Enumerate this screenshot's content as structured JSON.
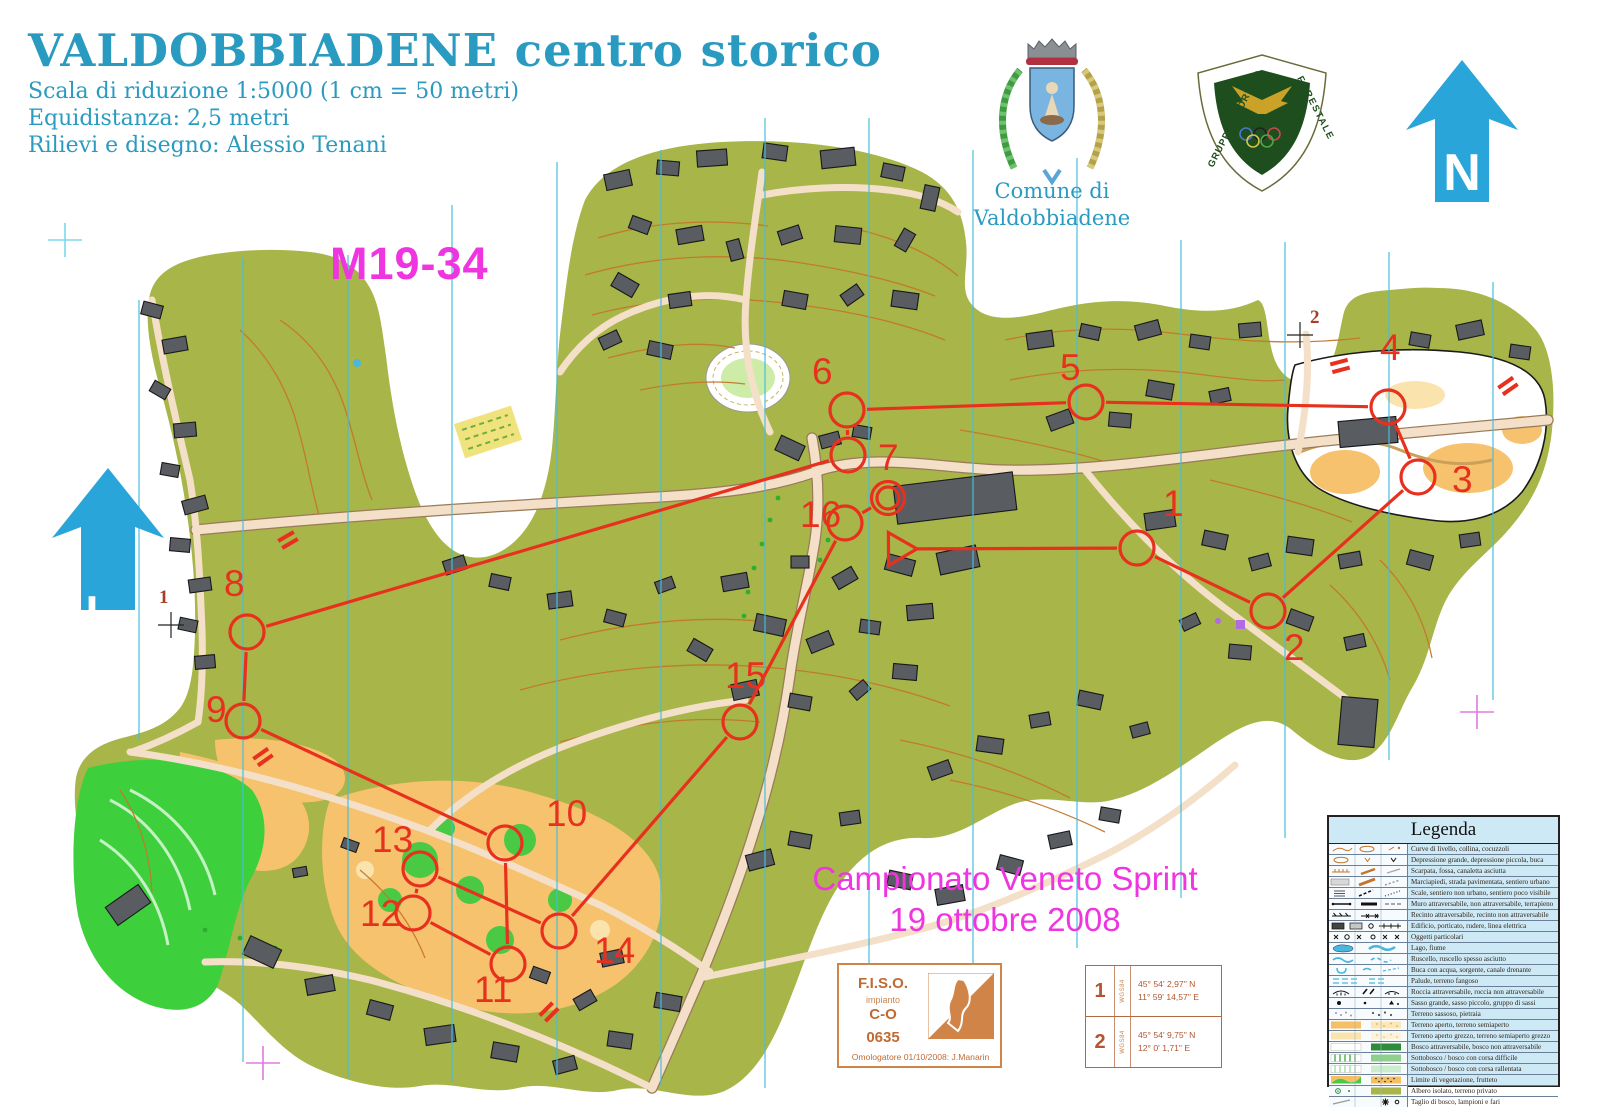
{
  "header": {
    "title": "VALDOBBIADENE",
    "title_suffix": " centro storico",
    "scale_line": "Scala di riduzione  1:5000 (1 cm = 50 metri)",
    "equidistance_line": "Equidistanza: 2,5 metri",
    "credits_line": "Rilievi e disegno: Alessio Tenani"
  },
  "class_label": "M19-34",
  "north_label": "N",
  "municipality": {
    "line1": "Comune di",
    "line2": "Valdobbiadene"
  },
  "forestale": {
    "arc_left": "GRUPPO SPORTIVO",
    "arc_right": "FORESTALE"
  },
  "event": {
    "line1": "Campionato Veneto Sprint",
    "line2": "19 ottobre 2008"
  },
  "fiso_box": {
    "org": "F.I.S.O.",
    "impianto": "impianto",
    "discipline": "C-O",
    "number": "0635",
    "footer": "Omologatore 01/10/2008: J.Manarin"
  },
  "coordinates_box": {
    "rows": [
      {
        "id": "1",
        "datum": "WGS84",
        "lat": "45° 54' 2,97\"  N",
        "lon": "11° 59' 14,57\" E"
      },
      {
        "id": "2",
        "datum": "WGS84",
        "lat": "45° 54' 9,75\" N",
        "lon": "12° 0' 1,71\" E"
      }
    ]
  },
  "registration": {
    "numbered": [
      {
        "id": "1",
        "tx": 159,
        "ty": 603,
        "cx": 171,
        "cy": 625
      },
      {
        "id": "2",
        "tx": 1310,
        "ty": 323,
        "cx": 1300,
        "cy": 335
      }
    ],
    "crosses": [
      {
        "x": 65,
        "y": 240,
        "color": "#7dd8f0"
      },
      {
        "x": 263,
        "y": 1063,
        "color": "#e07ae0"
      },
      {
        "x": 1477,
        "y": 712,
        "color": "#e07ae0"
      }
    ]
  },
  "course": {
    "color": "#e8301f",
    "start": {
      "x": 898,
      "y": 549
    },
    "finish": {
      "x": 888,
      "y": 498
    },
    "controls": [
      {
        "n": "1",
        "cx": 1137,
        "cy": 548,
        "nx": 1163,
        "ny": 516
      },
      {
        "n": "2",
        "cx": 1268,
        "cy": 611,
        "nx": 1284,
        "ny": 660
      },
      {
        "n": "3",
        "cx": 1418,
        "cy": 477,
        "nx": 1452,
        "ny": 492
      },
      {
        "n": "4",
        "cx": 1388,
        "cy": 407,
        "nx": 1380,
        "ny": 360
      },
      {
        "n": "5",
        "cx": 1086,
        "cy": 402,
        "nx": 1060,
        "ny": 380
      },
      {
        "n": "6",
        "cx": 847,
        "cy": 410,
        "nx": 812,
        "ny": 384
      },
      {
        "n": "7",
        "cx": 848,
        "cy": 455,
        "nx": 878,
        "ny": 470
      },
      {
        "n": "8",
        "cx": 247,
        "cy": 632,
        "nx": 224,
        "ny": 596
      },
      {
        "n": "9",
        "cx": 243,
        "cy": 721,
        "nx": 206,
        "ny": 722
      },
      {
        "n": "10",
        "cx": 505,
        "cy": 843,
        "nx": 546,
        "ny": 826
      },
      {
        "n": "11",
        "cx": 508,
        "cy": 964,
        "nx": 474,
        "ny": 1002
      },
      {
        "n": "12",
        "cx": 413,
        "cy": 913,
        "nx": 360,
        "ny": 926
      },
      {
        "n": "13",
        "cx": 420,
        "cy": 869,
        "nx": 372,
        "ny": 852
      },
      {
        "n": "14",
        "cx": 559,
        "cy": 931,
        "nx": 594,
        "ny": 963
      },
      {
        "n": "15",
        "cx": 740,
        "cy": 722,
        "nx": 725,
        "ny": 688
      },
      {
        "n": "16",
        "cx": 845,
        "cy": 523,
        "nx": 800,
        "ny": 527
      }
    ],
    "forbidden_marks": [
      {
        "x": 288,
        "y": 540,
        "rot": 60
      },
      {
        "x": 263,
        "y": 757,
        "rot": 55
      },
      {
        "x": 1340,
        "y": 366,
        "rot": 75
      },
      {
        "x": 1508,
        "y": 386,
        "rot": 55
      },
      {
        "x": 549,
        "y": 1012,
        "rot": 45
      }
    ]
  },
  "legend": {
    "title": "Legenda",
    "rows": [
      {
        "sym": "contours",
        "label": "Curve di livello, collina, cocuzzoli"
      },
      {
        "sym": "depression",
        "label": "Depressione grande, depressione piccola, buca"
      },
      {
        "sym": "earthbank",
        "label": "Scarpata, fossa, canaletta asciutta"
      },
      {
        "sym": "pavement",
        "label": "Marciapiedi, strada pavimentata, sentiero urbano"
      },
      {
        "sym": "steps",
        "label": "Scale, sentiero non urbano, sentiero poco visibile"
      },
      {
        "sym": "wall",
        "label": "Muro attraversabile, non attraversabile, terrapieno"
      },
      {
        "sym": "fence",
        "label": "Recinto attraversabile, recinto non attraversabile"
      },
      {
        "sym": "building",
        "label": "Edificio, porticato, rudere, linea elettrica"
      },
      {
        "sym": "objects",
        "label": "Oggetti particolari"
      },
      {
        "sym": "lake",
        "label": "Lago, fiume"
      },
      {
        "sym": "stream",
        "label": "Ruscello, ruscello spesso asciutto"
      },
      {
        "sym": "waterhole",
        "label": "Buca con acqua, sorgente, canale drenante"
      },
      {
        "sym": "marsh",
        "label": "Palude, terreno fangoso"
      },
      {
        "sym": "rock",
        "label": "Roccia attraversabile, roccia non attraversabile"
      },
      {
        "sym": "boulder",
        "label": "Sasso grande, sasso piccolo, gruppo di sassi"
      },
      {
        "sym": "stony",
        "label": "Terreno sassoso, pietraia"
      },
      {
        "sym": "open",
        "label": "Terreno aperto, terreno semiaperto"
      },
      {
        "sym": "rough_open",
        "label": "Terreno aperto grezzo, terreno semiaperto grezzo"
      },
      {
        "sym": "forest",
        "label": "Bosco attraversabile, bosco non attraversabile"
      },
      {
        "sym": "undergrowth_slow",
        "label": "Sottobosco / bosco con corsa difficile"
      },
      {
        "sym": "undergrowth_walk",
        "label": "Sottobosco / bosco con corsa rallentata"
      },
      {
        "sym": "veg_boundary",
        "label": "Limite di vegetazione, frutteto"
      },
      {
        "sym": "tree",
        "label": "Albero isolato, terreno privato"
      },
      {
        "sym": "cutting",
        "label": "Taglio di bosco, lampioni e fari"
      }
    ]
  },
  "map_colors": {
    "olive": "#a8b548",
    "open_orange": "#f6c26e",
    "bright_green": "#3ed03c",
    "road": "#f4e0c8",
    "building": "#595d61",
    "contour": "#c4772c",
    "north_line": "#45bede",
    "water": "#7fd0e8",
    "course_red": "#e8301f",
    "magenta": "#ee35e0",
    "teal": "#2a9bc0"
  }
}
